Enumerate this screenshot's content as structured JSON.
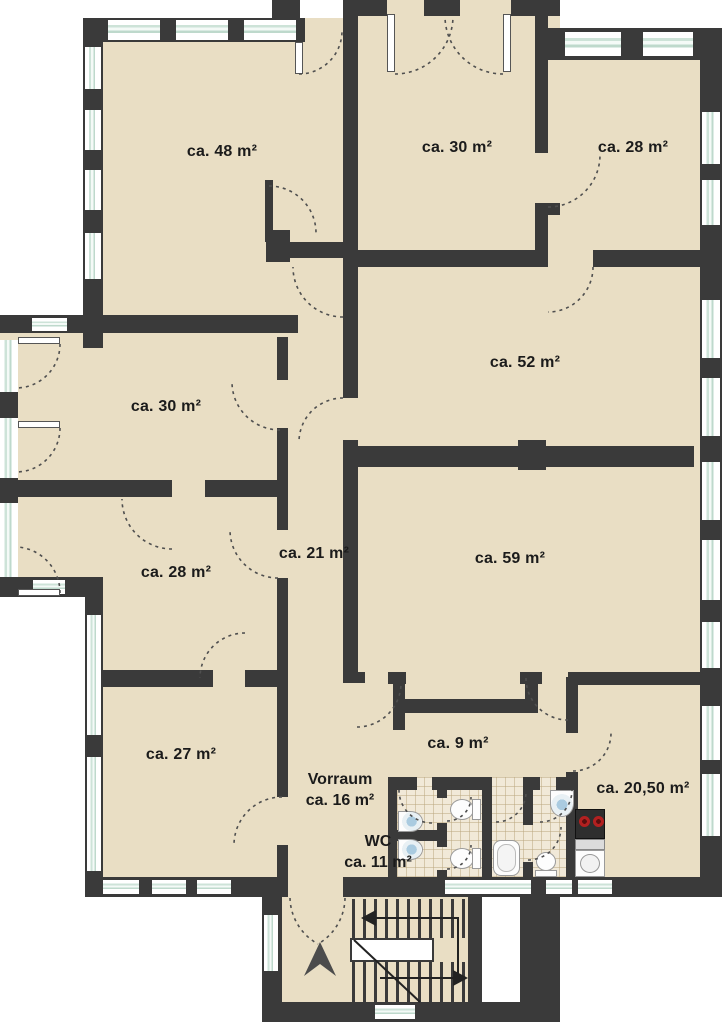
{
  "floorplan": {
    "type": "apartment-floor-plan",
    "rooms": [
      {
        "id": "room-48",
        "area_label": "ca. 48 m²"
      },
      {
        "id": "room-30-top",
        "area_label": "ca. 30 m²"
      },
      {
        "id": "room-28-top",
        "area_label": "ca. 28 m²"
      },
      {
        "id": "room-52",
        "area_label": "ca. 52 m²"
      },
      {
        "id": "room-30-left",
        "area_label": "ca. 30 m²"
      },
      {
        "id": "room-21",
        "area_label": "ca. 21 m²"
      },
      {
        "id": "room-28-left",
        "area_label": "ca. 28 m²"
      },
      {
        "id": "room-59",
        "area_label": "ca. 59 m²"
      },
      {
        "id": "room-27",
        "area_label": "ca. 27 m²"
      },
      {
        "id": "room-9",
        "area_label": "ca. 9 m²"
      },
      {
        "id": "vorraum",
        "name": "Vorraum",
        "area_label": "ca. 16 m²"
      },
      {
        "id": "wc",
        "name": "WC",
        "area_label": "ca. 11 m²"
      },
      {
        "id": "room-2050",
        "area_label": "ca. 20,50 m²"
      }
    ],
    "colors": {
      "wall": "#3a3a3a",
      "floor": "#e9dec4",
      "tile_floor": "#f1e9d8",
      "window_glass": "#cde3d8",
      "stove_burner": "#b32020",
      "north_arrow": "#4c4c4c",
      "label_text": "#1b1b1b"
    },
    "fixtures": [
      "staircase",
      "north-arrow",
      "toilet",
      "sink",
      "bathtub",
      "kitchen-stove",
      "kitchen-sink",
      "door-swing",
      "window",
      "chimney",
      "elevator-shaft"
    ]
  }
}
